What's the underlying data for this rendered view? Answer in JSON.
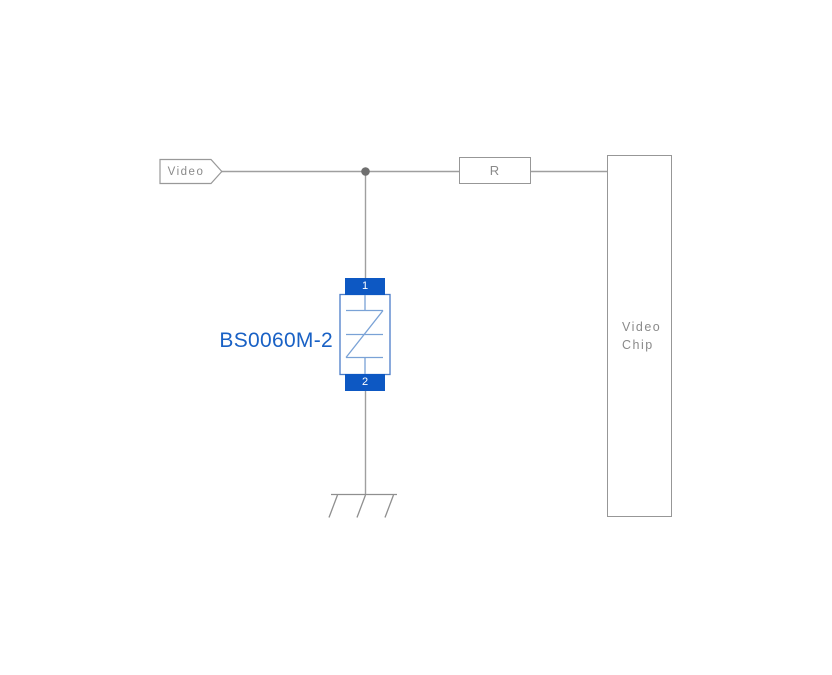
{
  "schematic": {
    "video_net": {
      "label": "Video"
    },
    "resistor": {
      "label": "R"
    },
    "video_chip": {
      "label": "Video Chip"
    },
    "tvs": {
      "part_number": "BS0060M-2",
      "pin_top": "1",
      "pin_bottom": "2"
    },
    "colors": {
      "wire_gray": "#9f9f9f",
      "outline_gray": "#979797",
      "label_gray": "#8a8a8a",
      "junction_gray": "#6f6f6f",
      "tvs_pad_blue": "#0d58c3",
      "tvs_body_border_blue": "#4a7cc8",
      "tvs_symbol_blue": "#7aa2d6",
      "part_number_blue": "#1961c5"
    }
  }
}
